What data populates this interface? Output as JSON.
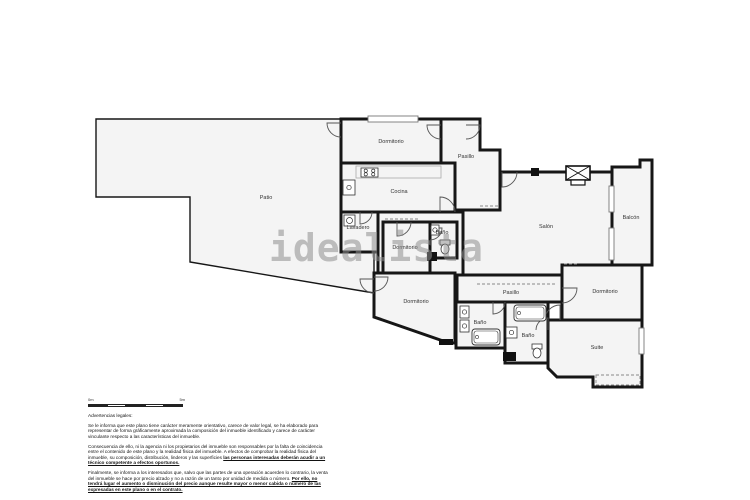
{
  "watermark": {
    "text": "idealista",
    "color": "#8f8f8f"
  },
  "scale_bar": {
    "left_label": "0m",
    "right_label": "5m"
  },
  "legal": {
    "heading": "Advertencias legales:",
    "p1": "Se le informa que este plano tiene carácter meramente orientativo, carece de valor legal, se ha elaborado para representar de forma gráficamente aproximada la composición del inmueble identificado y carece de carácter vinculante respecto a las características del inmueble.",
    "p2_normal": "Consecuencia de ello, ni la agencia ni los propietarios del inmueble son responsables por la falta de coincidencia entre el contenido de este plano y la realidad física del inmueble. A efectos de comprobar la realidad física del inmueble, su composición, distribución, linderos y las superficies",
    "p2_emphasis": "las personas interesadas deberán acudir a un técnico competente a efectos oportunos.",
    "p3_normal": "Finalmente, se informa a los interesados que, salvo que las partes de una operación acuerden lo contrario, la venta del inmueble se hace por precio alzado y no a razón de un tanto por unidad de medida o número.",
    "p3_emphasis": "Por ello, no tendrá lugar el aumento o disminución del precio aunque resulte mayor o menor cabida o número de las expresadas en este plano o en el contrato."
  },
  "floorplan": {
    "wall_color": "#161616",
    "room_fill": "#f4f4f4",
    "rooms": [
      {
        "id": "patio",
        "label": "Patio",
        "points": "96,119 341,119 341,250 374,250 374,293 190,262 190,197 96,197",
        "lx": 266,
        "ly": 199,
        "sw": 1.4
      },
      {
        "id": "hall",
        "label": "",
        "points": "378,212 463,212 463,275 378,275",
        "lx": 0,
        "ly": 0
      },
      {
        "id": "salon",
        "label": "Salón",
        "points": "500,172 612,172 612,265 562,265 562,275 463,275 463,210 500,210",
        "lx": 546,
        "ly": 228
      },
      {
        "id": "balcon",
        "label": "Balcón",
        "points": "612,167 640,167 640,160 652,160 652,265 612,265",
        "lx": 631,
        "ly": 219
      },
      {
        "id": "pasillo_top",
        "label": "Pasillo",
        "points": "441,119 480,119 480,150 500,150 500,210 455,210 455,163 441,163",
        "lx": 466,
        "ly": 158
      },
      {
        "id": "dormitorio_top",
        "label": "Dormitorio",
        "points": "341,119 441,119 441,163 341,163",
        "lx": 391,
        "ly": 143
      },
      {
        "id": "cocina",
        "label": "Cocina",
        "points": "341,163 455,163 455,212 341,212",
        "lx": 399,
        "ly": 193
      },
      {
        "id": "lavadero",
        "label": "Lavadero",
        "points": "341,212 378,212 378,252 341,252",
        "lx": 358,
        "ly": 229
      },
      {
        "id": "dormitorio_mid",
        "label": "Dormitorio",
        "points": "383,222 430,222 430,273 383,273",
        "lx": 405,
        "ly": 249
      },
      {
        "id": "bano_top",
        "label": "Baño",
        "points": "430,222 457,222 457,258 430,258",
        "lx": 442,
        "ly": 234
      },
      {
        "id": "dormitorio_bl",
        "label": "Dormitorio",
        "points": "374,273 455,273 455,343 449,343 374,317",
        "lx": 416,
        "ly": 303
      },
      {
        "id": "pasillo_bottom",
        "label": "Pasillo",
        "points": "457,275 562,275 562,302 457,302",
        "lx": 511,
        "ly": 294
      },
      {
        "id": "bano_left",
        "label": "Baño",
        "points": "456,302 505,302 505,348 456,348",
        "lx": 480,
        "ly": 324
      },
      {
        "id": "bano_right",
        "label": "Baño",
        "points": "505,302 548,302 548,363 505,363",
        "lx": 528,
        "ly": 337
      },
      {
        "id": "dormitorio_right",
        "label": "Dormitorio",
        "points": "562,265 642,265 642,320 562,320",
        "lx": 605,
        "ly": 293
      },
      {
        "id": "suite",
        "label": "Suite",
        "points": "548,320 642,320 642,387 593,387 593,377 557,377 548,368",
        "lx": 597,
        "ly": 349
      }
    ],
    "doors": [
      {
        "d": "M441,125 L427,125 A14,14 0 0 0 441,139"
      },
      {
        "d": "M466,125 L480,125 A14,14 0 0 1 466,139"
      },
      {
        "d": "M502,172 L502,187 A15,15 0 0 0 517,172"
      },
      {
        "d": "M440,212 L440,197 A15,15 0 0 1 455,212"
      },
      {
        "d": "M360,212 L360,224 A12,12 0 0 0 372,212"
      },
      {
        "d": "M397,222 L397,236 A14,14 0 0 0 411,222"
      },
      {
        "d": "M430,228 L442,228 A12,12 0 0 1 430,240"
      },
      {
        "d": "M374,277 L388,277 A14,14 0 0 1 374,291"
      },
      {
        "d": "M374,279 L360,279 A14,14 0 0 0 374,293"
      },
      {
        "d": "M562,288 L577,288 A15,15 0 0 1 562,303"
      },
      {
        "d": "M560,320 L560,305 A15,15 0 0 0 545,320"
      },
      {
        "d": "M493,302 L493,314 A12,12 0 0 0 505,302"
      },
      {
        "d": "M548,330 L548,318 A12,12 0 0 0 536,330"
      },
      {
        "d": "M341,123 L327,123 A14,14 0 0 0 341,137"
      }
    ],
    "windows": [
      {
        "x": 368,
        "y": 116,
        "w": 50,
        "h": 6
      },
      {
        "x": 609,
        "y": 186,
        "w": 5,
        "h": 26
      },
      {
        "x": 609,
        "y": 228,
        "w": 5,
        "h": 32
      },
      {
        "x": 639,
        "y": 328,
        "w": 5,
        "h": 26
      }
    ],
    "dashed_lines": [
      {
        "x1": 477,
        "y1": 284,
        "x2": 556,
        "y2": 284
      },
      {
        "x1": 480,
        "y1": 206,
        "x2": 500,
        "y2": 206
      },
      {
        "x1": 385,
        "y1": 219,
        "x2": 418,
        "y2": 219
      },
      {
        "x1": 564,
        "y1": 264,
        "x2": 578,
        "y2": 264
      }
    ],
    "dashed_rects": [
      {
        "x": 596,
        "y": 375,
        "w": 44,
        "h": 10
      }
    ],
    "x_window": {
      "x": 566,
      "y": 166,
      "w": 24,
      "h": 14
    },
    "fixtures": [
      {
        "type": "counter",
        "x": 356,
        "y": 166,
        "w": 85,
        "h": 12
      },
      {
        "type": "stove",
        "x": 361,
        "y": 168,
        "w": 17,
        "h": 9
      },
      {
        "type": "sink",
        "x": 343,
        "y": 180,
        "w": 12,
        "h": 15
      },
      {
        "type": "washer",
        "x": 344,
        "y": 215,
        "w": 11,
        "h": 11
      },
      {
        "type": "sink",
        "x": 431,
        "y": 225,
        "w": 8,
        "h": 10
      },
      {
        "type": "toilet",
        "x": 445,
        "y": 250
      },
      {
        "type": "sink",
        "x": 460,
        "y": 306,
        "w": 9,
        "h": 12
      },
      {
        "type": "sink",
        "x": 460,
        "y": 320,
        "w": 9,
        "h": 12
      },
      {
        "type": "tub",
        "x": 472,
        "y": 329,
        "w": 28,
        "h": 16
      },
      {
        "type": "tub",
        "x": 514,
        "y": 305,
        "w": 32,
        "h": 16
      },
      {
        "type": "sink",
        "x": 506,
        "y": 327,
        "w": 11,
        "h": 11
      },
      {
        "type": "toilet",
        "x": 537,
        "y": 354
      },
      {
        "type": "pillar",
        "x": 531,
        "y": 168,
        "w": 8,
        "h": 8
      },
      {
        "type": "pillar",
        "x": 427,
        "y": 252,
        "w": 10,
        "h": 9
      },
      {
        "type": "pillar",
        "x": 503,
        "y": 352,
        "w": 13,
        "h": 9
      },
      {
        "type": "pillar",
        "x": 439,
        "y": 339,
        "w": 14,
        "h": 6
      }
    ]
  }
}
